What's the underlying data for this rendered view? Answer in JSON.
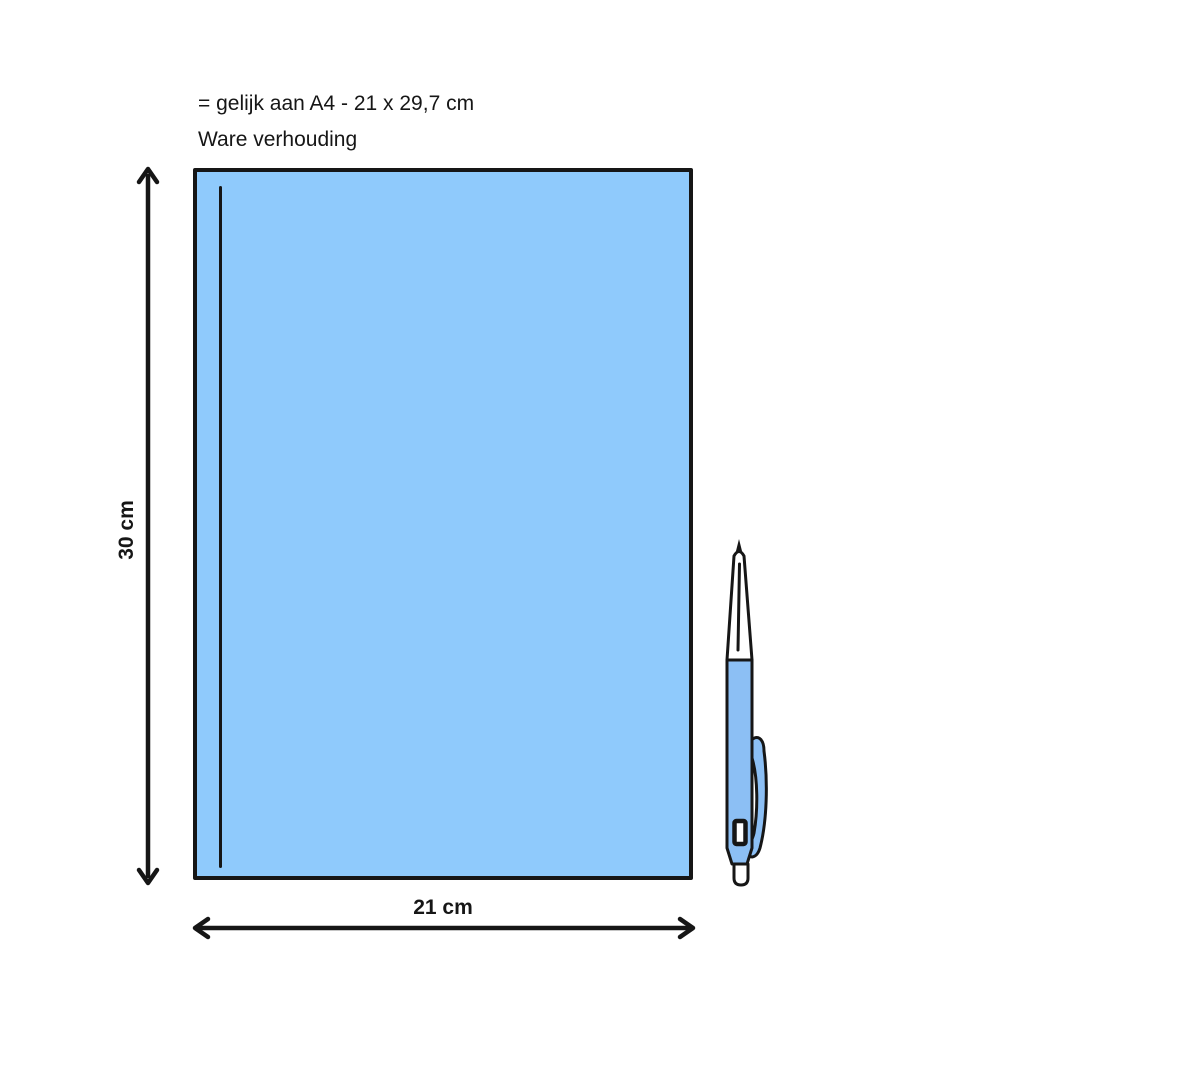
{
  "diagram": {
    "title_line1": "= gelijk aan A4 - 21 x 29,7 cm",
    "title_line2": "Ware verhouding",
    "paper": {
      "height_label": "30 cm",
      "width_label": "21 cm"
    },
    "colors": {
      "outline": "#161616",
      "paper_fill": "#8FCAFC",
      "pen_fill": "#8CBFF4",
      "background": "#FFFFFF"
    },
    "icons": {
      "pen": "ballpoint-pen-illustration",
      "height_arrow": "double-arrow-vertical-icon",
      "width_arrow": "double-arrow-horizontal-icon"
    }
  }
}
